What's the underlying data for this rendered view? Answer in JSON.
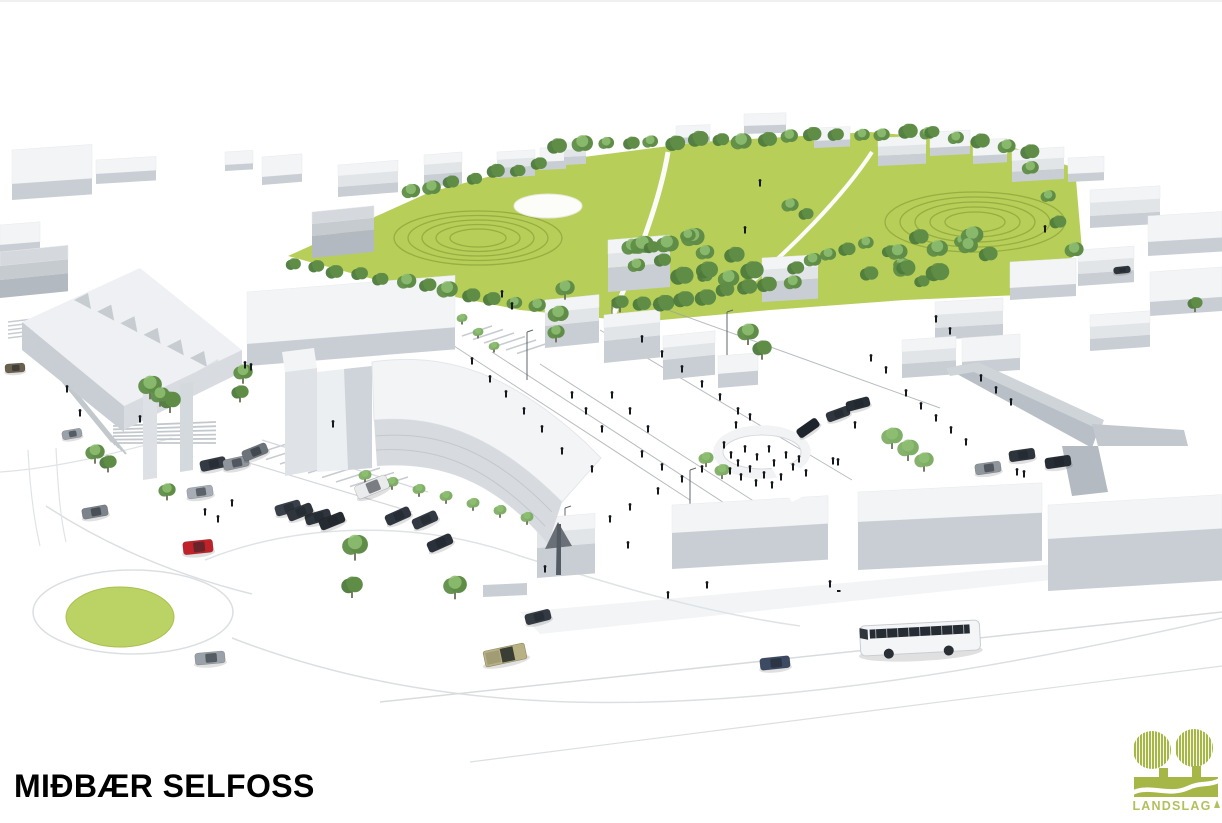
{
  "slide": {
    "title": "MIÐBÆR SELFOSS"
  },
  "logo": {
    "text": "LANDSLAG"
  },
  "scene": {
    "alt": "Aerial 3D architectural rendering of the Selfoss town centre masterplan: a large green park with perimeter tree rows and terraced circular lawns, white low-poly buildings, a curved central building over an archway, a pedestrian plaza with scattered people, parking lots with cars, a roundabout with a green island, a red car, a coach bus and a pickup truck on the main street"
  },
  "colors": {
    "park_green": "#b7ce59",
    "island_green": "#bad364",
    "tree_dark": "#4d7a3c",
    "tree_mid": "#5f8d47",
    "tree_light": "#7fae66",
    "terrace_line": "#8fa63c",
    "building_top": "#f3f4f6",
    "building_mid": "#e2e5e8",
    "building_side": "#c9ced4",
    "building_gray": "#b9bfc6",
    "road_line": "#dcdfe2",
    "stripe_line": "#c7ccd1",
    "car_red": "#c0222a",
    "people": "#15181c",
    "logo_green": "#a6b748",
    "logo_text": "#b4c05e",
    "title_color": "#000000"
  }
}
